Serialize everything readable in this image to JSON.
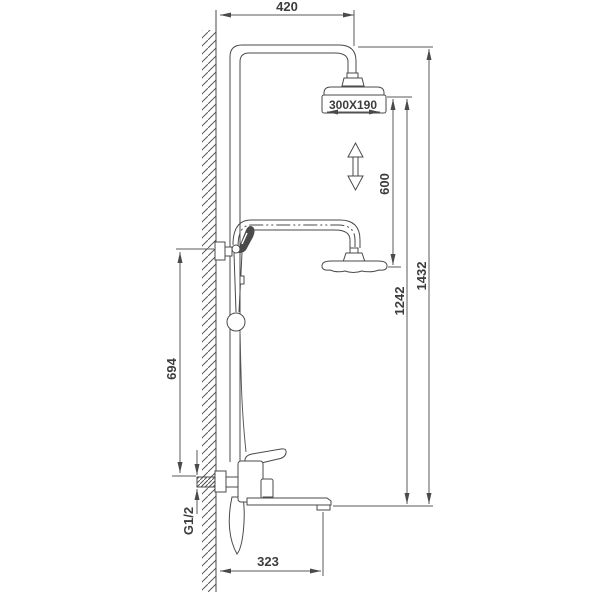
{
  "page": {
    "background": "#ffffff"
  },
  "drawing": {
    "type": "technical-line-drawing",
    "subject": "wall-mounted shower column with overhead shower, hand shower and mixer",
    "line_color": "#4a4a4a",
    "labels": {
      "arm_reach": "420",
      "head_size": "300X190",
      "height_adjustment": "600",
      "head_to_spout_height": "1242",
      "overall_height": "1432",
      "slide_bar_height": "694",
      "inlet_thread": "G1/2",
      "spout_reach": "323"
    }
  }
}
